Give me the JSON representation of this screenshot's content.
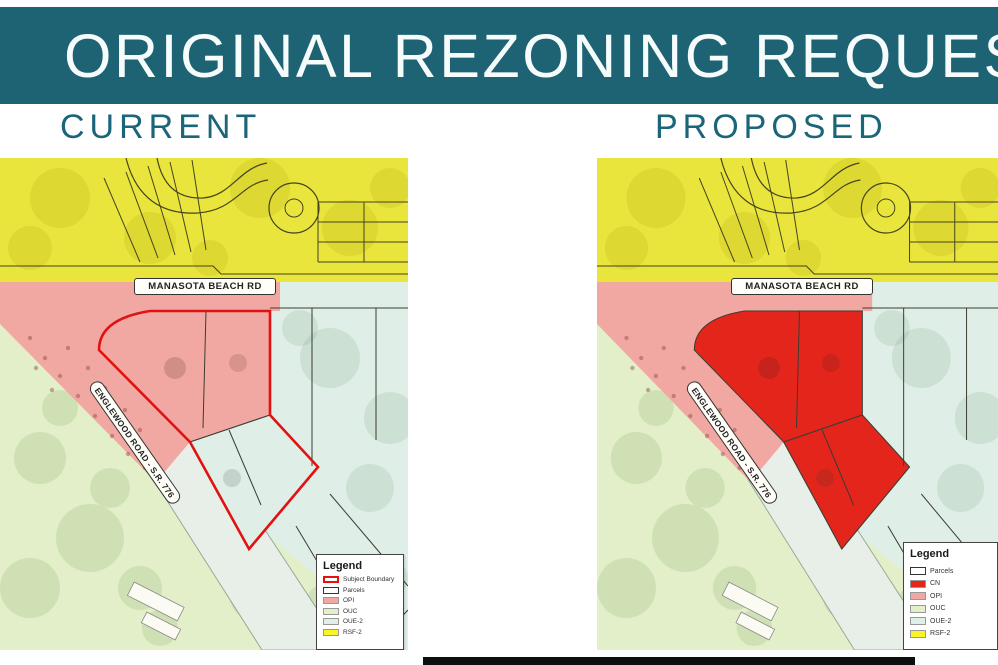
{
  "header": {
    "title": "ORIGINAL REZONING REQUEST"
  },
  "columns": {
    "left_label": "CURRENT",
    "right_label": "PROPOSED"
  },
  "road_labels": {
    "manasota": "MANASOTA BEACH RD",
    "englewood": "ENGLEWOOD ROAD - S.R. 776"
  },
  "colors": {
    "banner": "#1d6373",
    "heading_text": "#1a6579",
    "rsf2_yellow": "#e9e53c",
    "opi_pink": "#f2a8a2",
    "cn_red": "#e3251c",
    "ouc_green": "#e2efc8",
    "oue2_green": "#dfeee6",
    "road_band": "#e7efe8",
    "subject_outline": "#e01212",
    "parcel_line": "#3c3c30"
  },
  "maps": {
    "current": {
      "legend": {
        "title": "Legend",
        "entries": [
          {
            "label": "Subject Boundary",
            "swatch": "subject"
          },
          {
            "label": "Parcels",
            "swatch": "parcels"
          },
          {
            "label": "OPI",
            "swatch": "opi"
          },
          {
            "label": "OUC",
            "swatch": "ouc"
          },
          {
            "label": "OUE-2",
            "swatch": "oue2"
          },
          {
            "label": "RSF-2",
            "swatch": "rsf2"
          }
        ]
      }
    },
    "proposed": {
      "legend": {
        "title": "Legend",
        "entries": [
          {
            "label": "Parcels",
            "swatch": "parcels"
          },
          {
            "label": "CN",
            "swatch": "cn"
          },
          {
            "label": "OPI",
            "swatch": "opi"
          },
          {
            "label": "OUC",
            "swatch": "ouc"
          },
          {
            "label": "OUE-2",
            "swatch": "oue2"
          },
          {
            "label": "RSF-2",
            "swatch": "rsf2"
          }
        ]
      }
    }
  }
}
